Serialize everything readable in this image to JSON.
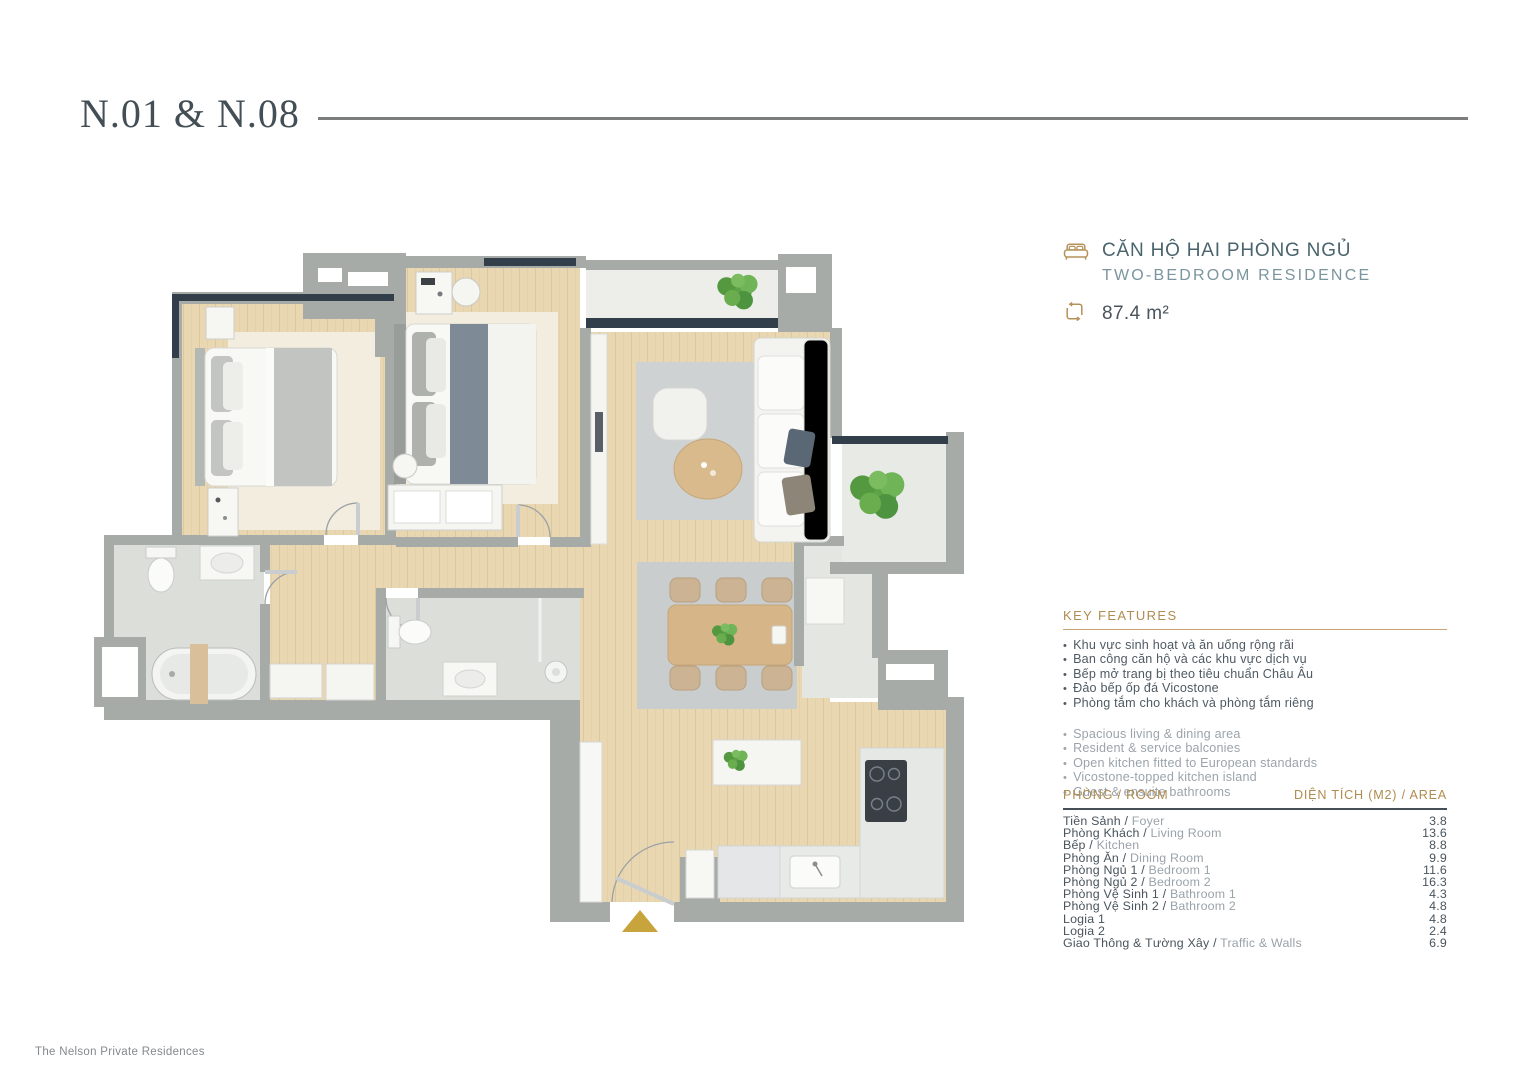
{
  "page": {
    "title_code": "N.01 & N.08",
    "footer": "The Nelson Private Residences"
  },
  "unit": {
    "type_vi": "CĂN HỘ HAI PHÒNG NGỦ",
    "type_en": "TWO-BEDROOM RESIDENCE",
    "area": "87.4 m²"
  },
  "key_features": {
    "heading": "KEY FEATURES",
    "items_vi": [
      "Khu vực sinh hoạt và ăn uống rộng rãi",
      "Ban công căn hộ và các khu vực dịch vụ",
      "Bếp mở trang bị theo tiêu chuẩn Châu Âu",
      "Đảo bếp ốp đá Vicostone",
      "Phòng tắm cho khách và phòng tắm riêng"
    ],
    "items_en": [
      "Spacious living & dining area",
      "Resident & service balconies",
      "Open kitchen fitted to European standards",
      "Vicostone-topped kitchen island",
      "Guest & ensuite bathrooms"
    ]
  },
  "room_table": {
    "col_room": "PHÒNG / ROOM",
    "col_area": "DIỆN TÍCH (M2) / AREA",
    "rows": [
      {
        "vi": "Tiền Sảnh",
        "en": "Foyer",
        "area": "3.8"
      },
      {
        "vi": "Phòng Khách",
        "en": "Living Room",
        "area": "13.6"
      },
      {
        "vi": "Bếp",
        "en": "Kitchen",
        "area": "8.8"
      },
      {
        "vi": "Phòng Ăn",
        "en": "Dining Room",
        "area": "9.9"
      },
      {
        "vi": "Phòng Ngủ 1",
        "en": "Bedroom 1",
        "area": "11.6"
      },
      {
        "vi": "Phòng Ngủ 2",
        "en": "Bedroom 2",
        "area": "16.3"
      },
      {
        "vi": "Phòng Vệ Sinh 1",
        "en": "Bathroom 1",
        "area": "4.3"
      },
      {
        "vi": "Phòng Vệ Sinh 2",
        "en": "Bathroom 2",
        "area": "4.8"
      },
      {
        "vi": "Logia 1",
        "en": "",
        "area": "4.8"
      },
      {
        "vi": "Logia 2",
        "en": "",
        "area": "2.4"
      },
      {
        "vi": "Giao Thông & Tường Xây",
        "en": "Traffic & Walls",
        "area": "6.9"
      }
    ]
  },
  "colors": {
    "accent_gold": "#b08c50",
    "entry_arrow_gold": "#c8a43d",
    "heading_teal": "#4a646d",
    "subheading_teal": "#7a959e",
    "body_dark": "#49545c",
    "body_gray": "#9aa3aa",
    "wall_gray": "#a6aba7",
    "window_navy": "#323e4a",
    "wood_floor": "#e9d7b1",
    "plant_green": "#5ea347"
  }
}
